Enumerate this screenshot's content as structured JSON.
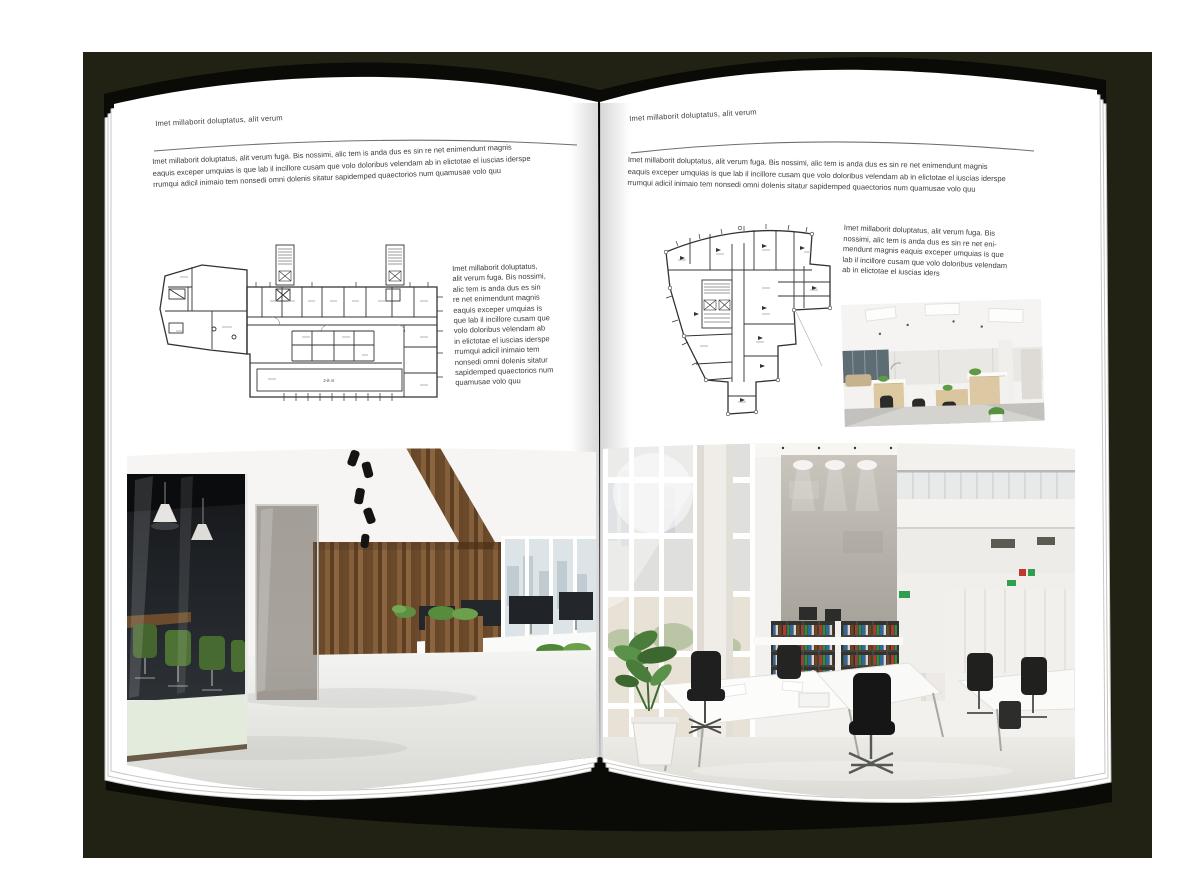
{
  "scene": {
    "backdrop_color": "#212114",
    "paper_color": "#ffffff",
    "text_color": "#3c3c3c"
  },
  "left_page": {
    "header": "Imet millaborit doluptatus, alit verum",
    "intro_lines": [
      "Imet millaborit doluptatus, alit verum fuga. Bis nossimi, alic tem is anda dus es sin re net enimendunt magnis",
      "eaquis exceper umquias is que lab il incillore cusam que volo doloribus velendam ab in elictotae el iuscias iderspe",
      "rrumqui adicil inimaio tem nonsedi omni dolenis sitatur sapidemped quaectorios num quamusae volo quu"
    ],
    "caption_lines": [
      "Imet millaborit doluptatus,",
      "alit verum fuga. Bis nossimi,",
      "alic tem is anda dus es sin",
      "re net enimendunt magnis",
      "eaquis exceper umquias is",
      "que lab il incillore cusam que",
      "volo doloribus velendam ab",
      "in elictotae el iuscias iderspe",
      "rrumqui adicil inimaio tem",
      "nonsedi omni dolenis sitatur",
      "sapidemped quaectorios num",
      "quamusae volo quu"
    ],
    "floor_plan_label": "2-й эт"
  },
  "right_page": {
    "header": "Imet millaborit doluptatus, alit verum",
    "intro_lines": [
      "Imet millaborit doluptatus, alit verum fuga. Bis nossimi, alic tem is anda dus es sin re net enimendunt magnis",
      "eaquis exceper umquias is que lab il incillore cusam que volo doloribus velendam ab in elictotae el iuscias iderspe",
      "rrumqui adicil inimaio tem nonsedi omni dolenis sitatur sapidemped quaectorios num quamusae volo quu"
    ],
    "caption_lines": [
      "Imet millaborit doluptatus, alit verum fuga. Bis",
      "nossimi, alic tem is anda dus es sin re net eni-",
      "mendunt magnis eaquis exceper umquias is que",
      "lab il incillore cusam que volo doloribus velendam",
      "ab in elictotae el iuscias iders"
    ]
  }
}
